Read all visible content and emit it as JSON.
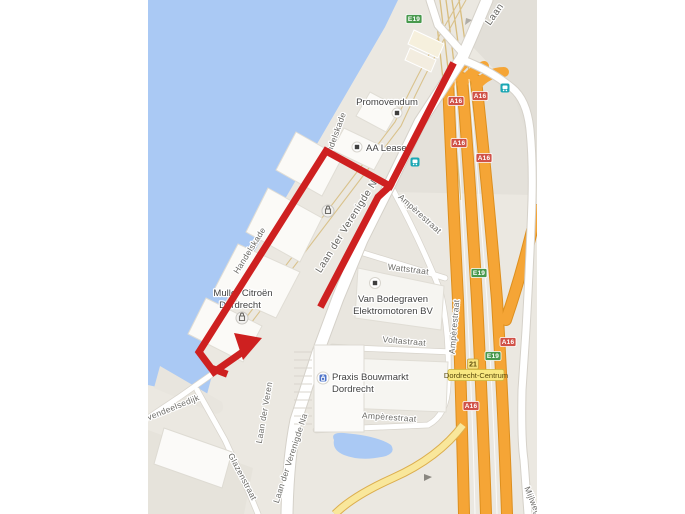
{
  "map": {
    "street_labels": [
      {
        "text": "Laan"
      },
      {
        "text": "ndelskade"
      },
      {
        "text": "Handelskade"
      },
      {
        "text": "Laan der Verenigde N"
      },
      {
        "text": "Ampèrestraat"
      },
      {
        "text": "Wattstraat"
      },
      {
        "text": "Ampèrestraat"
      },
      {
        "text": "Voltastraat"
      },
      {
        "text": "Ampèrestraat"
      },
      {
        "text": "Laan der Veren"
      },
      {
        "text": "Laan der Verenigde Na"
      },
      {
        "text": "ëvendeelsedijk"
      },
      {
        "text": "Glazenstraat"
      },
      {
        "text": "Mijlweg"
      }
    ],
    "pois": [
      {
        "name": "Promovendum"
      },
      {
        "name": "AA Lease"
      },
      {
        "line1": "Muller Citroën",
        "line2": "Dordrecht"
      },
      {
        "line1": "Van Bodegraven",
        "line2": "Elektromotoren BV"
      },
      {
        "line1": "Praxis Bouwmarkt",
        "line2": "Dordrecht"
      }
    ],
    "shields": {
      "a16": "A16",
      "e19": "E19"
    },
    "exit": {
      "number": "21",
      "destination": "Dordrecht-Centrum"
    },
    "colors": {
      "water": "#aac9f4",
      "land": "#ebe8e1",
      "land_dark": "#e4e1da",
      "road": "#ffffff",
      "motorway": "#f5a536",
      "motorway_casing": "#dd8f1e",
      "ramp_yellow": "#f9e79b",
      "rail": "#d8bd7e",
      "route_red": "#ce2020",
      "shield_a_red": "#d05248",
      "shield_e_green": "#48994d",
      "transit_teal": "#1ba7b4",
      "exit_yellow": "#f6e27c"
    }
  }
}
